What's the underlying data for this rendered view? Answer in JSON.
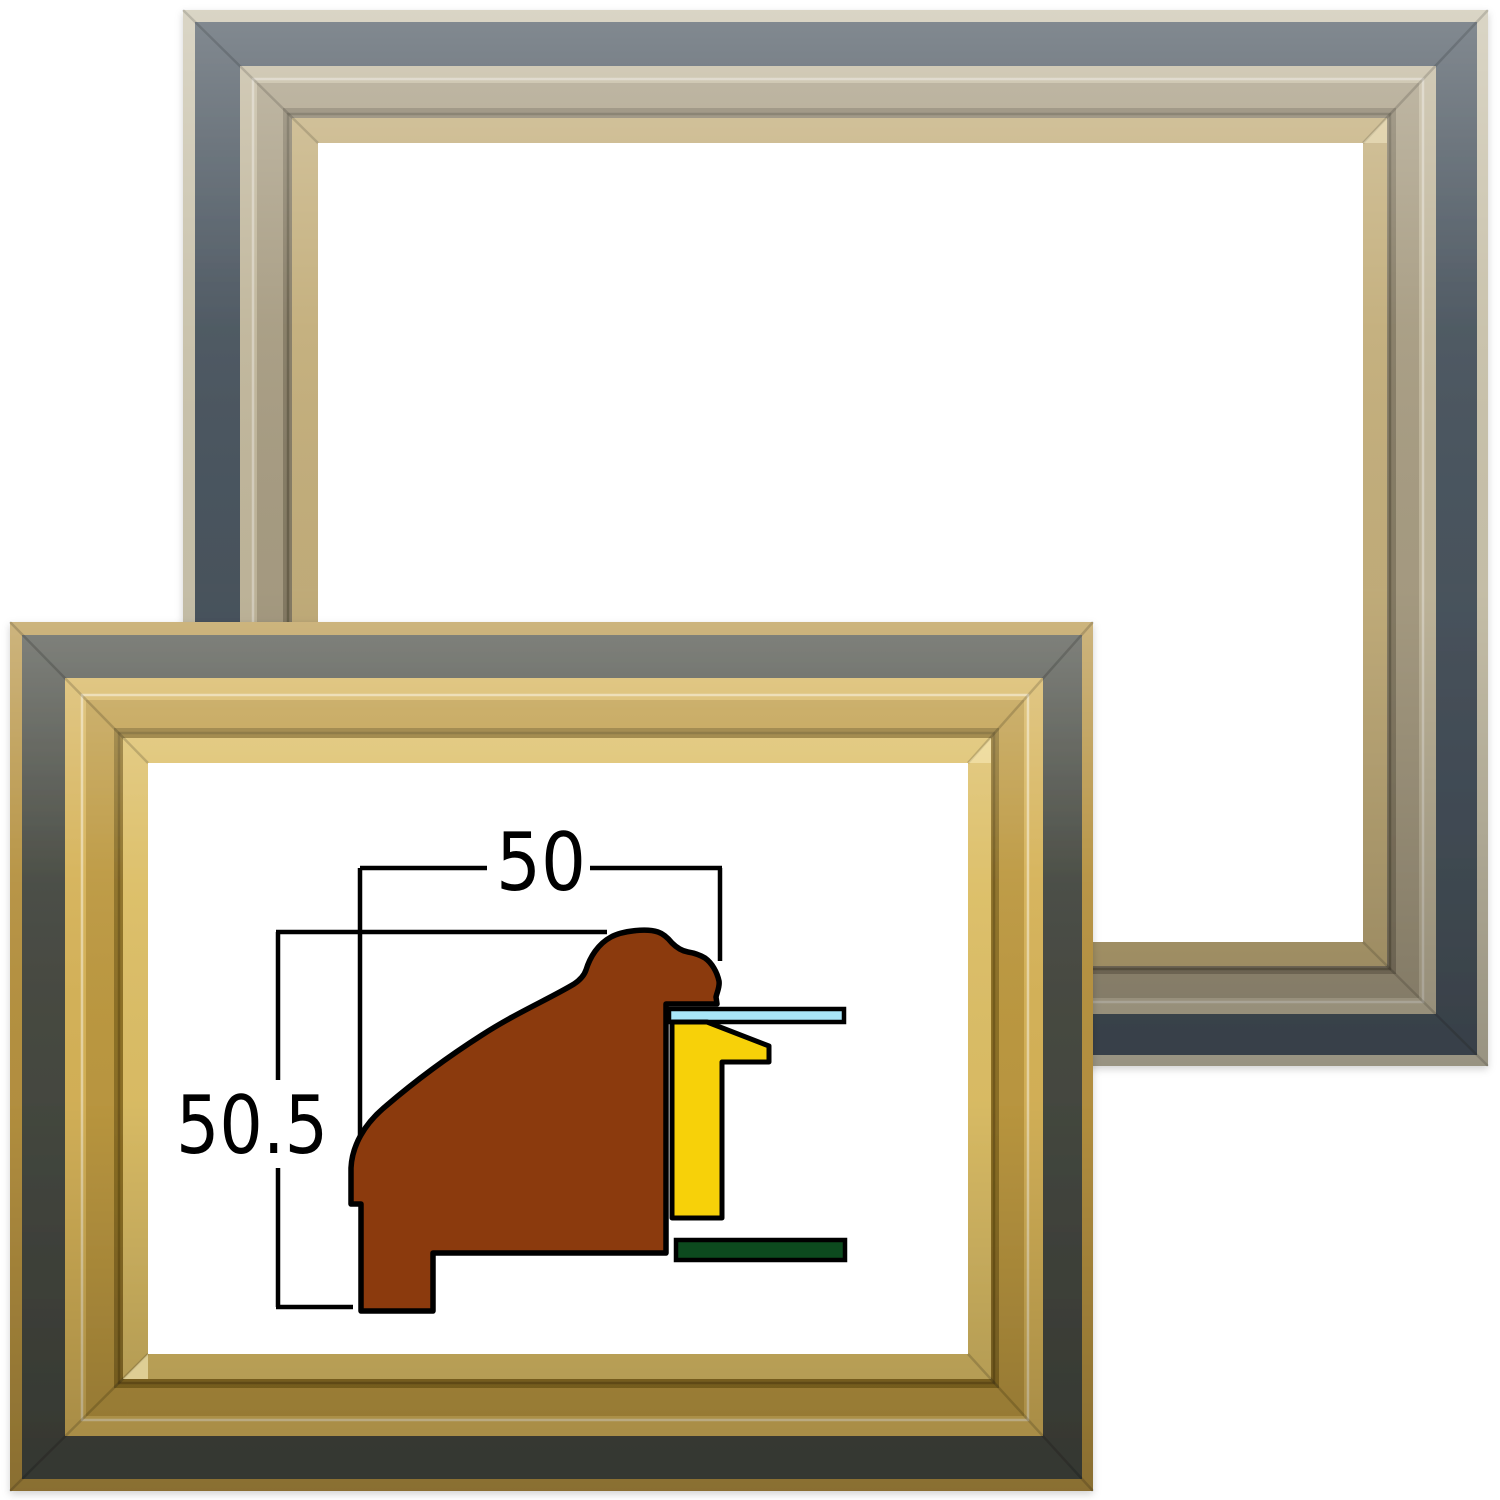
{
  "image": {
    "description": "Two empty wooden picture frames shown corner-overlapped, with a moulding cross-section diagram and its millimetre dimensions drawn inside the front frame opening",
    "background": "#FFFFFF"
  },
  "cross_section": {
    "width_label": "50",
    "height_label": "50.5",
    "line_color": "#000000",
    "moulding_color": "#8B3A0D",
    "liner_color": "#F7D109",
    "glass_color": "#A9E6F8",
    "backboard_color": "#0C4A1E"
  },
  "back_frame": {
    "label": "silver frame with dark blue-grey band",
    "edge": "#C8C1AA",
    "band": "#49545E",
    "molding_outer": "#C0B69B",
    "molding_mid": "#A79C82",
    "molding_shadow": "#867C65",
    "lip": "#C3AE7B"
  },
  "front_frame": {
    "label": "gold frame with dark charcoal band",
    "edge": "#B59140",
    "band": "#454840",
    "molding_outer": "#D5B258",
    "molding_mid": "#BC9840",
    "molding_shadow": "#8D7026",
    "lip": "#DCBE66"
  }
}
